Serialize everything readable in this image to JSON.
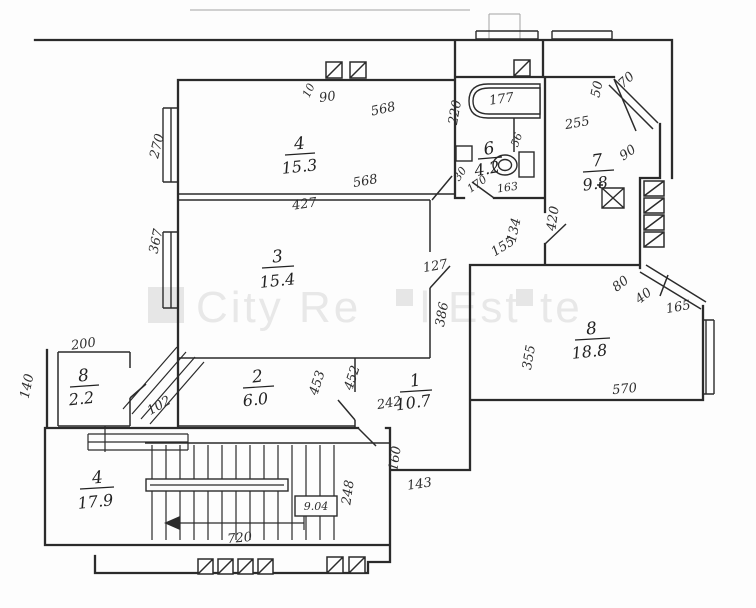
{
  "title": "apartment floor plan scan",
  "colors": {
    "ink": "#2b2b2b",
    "paper": "#fdfdfd",
    "watermark": "#e8e8e8"
  },
  "watermark": {
    "text": "City Real Estate",
    "parts": [
      "City Re",
      "l Est",
      "te"
    ]
  },
  "rooms": {
    "room4": {
      "num": "4",
      "area": "15.3"
    },
    "room3": {
      "num": "3",
      "area": "15.4"
    },
    "room2": {
      "num": "2",
      "area": "6.0"
    },
    "hall1": {
      "num": "1",
      "area": "10.7"
    },
    "bath6": {
      "num": "6",
      "area": "4.2"
    },
    "kitchen7": {
      "num": "7",
      "area": "9.8"
    },
    "room8": {
      "num": "8",
      "area": "18.8"
    },
    "closet": {
      "num": "8",
      "area": "2.2"
    },
    "stairhall": {
      "num": "4",
      "area": "17.9"
    }
  },
  "dims": [
    "90",
    "10",
    "568",
    "270",
    "568",
    "427",
    "367",
    "127",
    "386",
    "220",
    "177",
    "56",
    "30",
    "170",
    "163",
    "255",
    "50",
    "70",
    "90",
    "420",
    "134",
    "155",
    "80",
    "40",
    "165",
    "355",
    "570",
    "453",
    "452",
    "242",
    "160",
    "143",
    "248",
    "720",
    "200",
    "140",
    "102",
    "9.04"
  ]
}
